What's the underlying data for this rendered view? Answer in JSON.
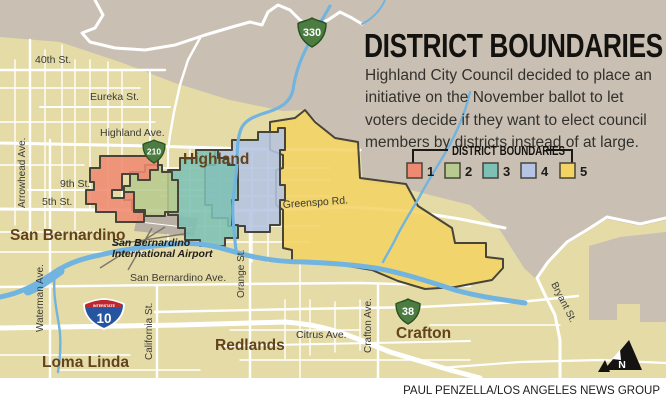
{
  "title": "DISTRICT BOUNDARIES",
  "description_lines": [
    "Highland City Council decided to place an",
    "initiative on the November ballot to let",
    "voters decide if they want to elect council",
    "members by districts instead of at large."
  ],
  "legend": {
    "title": "DISTRICT BOUNDARIES",
    "items": [
      {
        "label": "1",
        "color": "#ef8a72"
      },
      {
        "label": "2",
        "color": "#b7cb8f"
      },
      {
        "label": "3",
        "color": "#7dc0b4"
      },
      {
        "label": "4",
        "color": "#b4c4e2"
      },
      {
        "label": "5",
        "color": "#f4d365"
      }
    ]
  },
  "map": {
    "cities": {
      "san_bernardino": "San Bernardino",
      "highland": "Highland",
      "redlands": "Redlands",
      "loma_linda": "Loma Linda",
      "crafton": "Crafton"
    },
    "airport": {
      "line1": "San Bernardino",
      "line2": "International Airport"
    },
    "streets": {
      "fortieth": "40th St.",
      "eureka": "Eureka St.",
      "highland_ave": "Highland Ave.",
      "ninth": "9th St.",
      "fifth": "5th St.",
      "greenspot": "Greenspo Rd.",
      "san_bernardino_ave": "San Bernardino Ave.",
      "citrus": "Citrus Ave.",
      "arrowhead": "Arrowhead Ave.",
      "waterman": "Waterman Ave.",
      "california": "California St.",
      "orange": "Orange St.",
      "crafton_ave": "Crafton Ave.",
      "bryant": "Bryant St."
    },
    "routes": {
      "state_330": "330",
      "state_210": "210",
      "interstate_10": "10",
      "interstate_label": "INTERSTATE",
      "state_38": "38"
    },
    "north_label": "N",
    "colors": {
      "land": "#e4dba7",
      "terrain": "#c9c0b3",
      "river": "#72b4e0",
      "district_border": "#47443a"
    }
  },
  "credit": "PAUL PENZELLA/LOS ANGELES NEWS GROUP"
}
